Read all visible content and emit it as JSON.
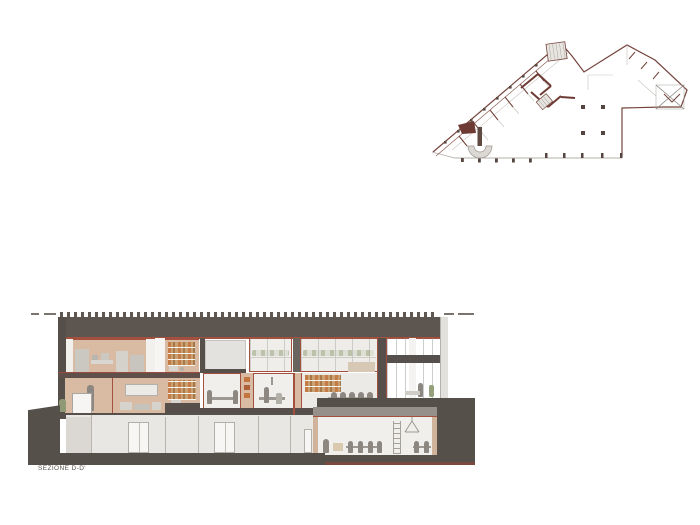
{
  "section": {
    "label": "SEZIONE D-D'",
    "figure": "building-cross-section",
    "floors": [
      "upper-floor",
      "mid-floor",
      "ground-floor",
      "basement-room"
    ]
  },
  "plan": {
    "figure": "key-floor-plan"
  },
  "theme": {
    "ink": "#56504a",
    "accent": "#a3503f",
    "wallTan": "#d8bba2",
    "glass": "#e9ebea",
    "paper": "#f0efec",
    "planLine": "#74443c",
    "planLight": "#b5b1ab",
    "bookOrange": "#c4743e",
    "olive": "#96a07c"
  }
}
